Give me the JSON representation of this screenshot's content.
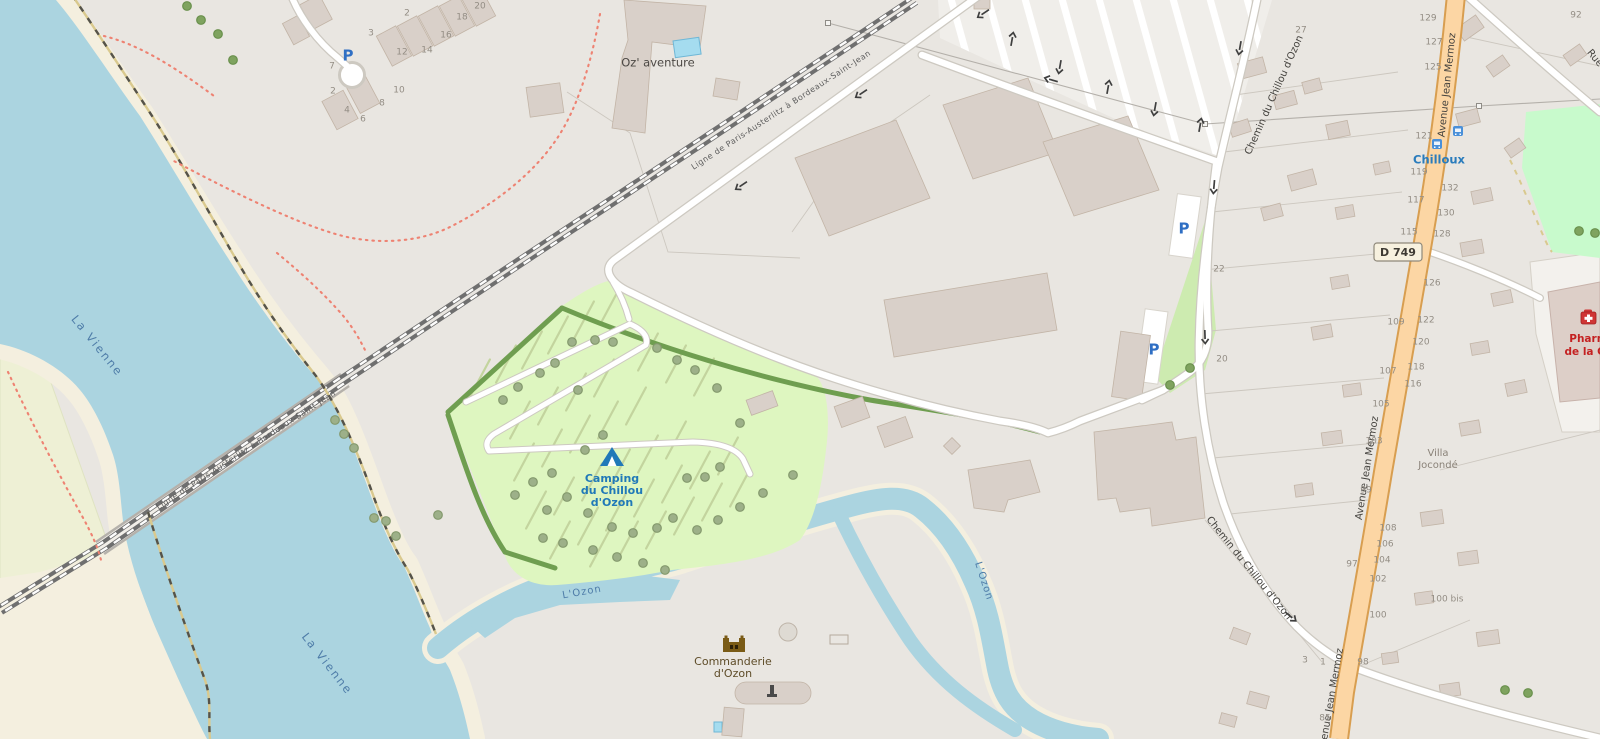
{
  "labels": {
    "la_vienne": "La Vienne",
    "l_ozon": "L'Ozon",
    "railway": "Ligne de Paris-Austerlitz à Bordeaux-Saint-Jean",
    "avenue": "Avenue Jean Mermoz",
    "chemin": "Chemin du Chillou d'Ozon",
    "rue_partial": "Rue",
    "road_ref": "D 749",
    "oz_aventure": "Oz' aventure",
    "camping_l1": "Camping",
    "camping_l2": "du Chillou",
    "camping_l3": "d'Ozon",
    "commanderie_l1": "Commanderie",
    "commanderie_l2": "d'Ozon",
    "bus_stop": "Chilloux",
    "pharmacy_l1": "Pharma",
    "pharmacy_l2": "de la Che",
    "villa_l1": "Villa",
    "villa_l2": "Jocondé",
    "parking": "P"
  },
  "house_numbers": [
    {
      "t": "129",
      "x": 1428,
      "y": 18
    },
    {
      "t": "127",
      "x": 1434,
      "y": 42
    },
    {
      "t": "125",
      "x": 1433,
      "y": 67
    },
    {
      "t": "121",
      "x": 1424,
      "y": 136
    },
    {
      "t": "119",
      "x": 1419,
      "y": 172
    },
    {
      "t": "117",
      "x": 1416,
      "y": 200
    },
    {
      "t": "115",
      "x": 1409,
      "y": 232
    },
    {
      "t": "132",
      "x": 1450,
      "y": 188
    },
    {
      "t": "130",
      "x": 1446,
      "y": 213
    },
    {
      "t": "128",
      "x": 1442,
      "y": 234
    },
    {
      "t": "126",
      "x": 1432,
      "y": 283
    },
    {
      "t": "122",
      "x": 1426,
      "y": 320
    },
    {
      "t": "120",
      "x": 1421,
      "y": 342
    },
    {
      "t": "118",
      "x": 1416,
      "y": 367
    },
    {
      "t": "116",
      "x": 1413,
      "y": 384
    },
    {
      "t": "109",
      "x": 1396,
      "y": 322
    },
    {
      "t": "107",
      "x": 1388,
      "y": 371
    },
    {
      "t": "105",
      "x": 1381,
      "y": 404
    },
    {
      "t": "103",
      "x": 1374,
      "y": 441
    },
    {
      "t": "99",
      "x": 1366,
      "y": 490
    },
    {
      "t": "97",
      "x": 1352,
      "y": 564
    },
    {
      "t": "108",
      "x": 1388,
      "y": 528
    },
    {
      "t": "106",
      "x": 1385,
      "y": 544
    },
    {
      "t": "104",
      "x": 1382,
      "y": 560
    },
    {
      "t": "102",
      "x": 1378,
      "y": 579
    },
    {
      "t": "100",
      "x": 1378,
      "y": 615
    },
    {
      "t": "100 bis",
      "x": 1447,
      "y": 599
    },
    {
      "t": "98",
      "x": 1363,
      "y": 662
    },
    {
      "t": "85",
      "x": 1325,
      "y": 718
    },
    {
      "t": "92",
      "x": 1576,
      "y": 15
    },
    {
      "t": "27",
      "x": 1301,
      "y": 30
    },
    {
      "t": "22",
      "x": 1219,
      "y": 269
    },
    {
      "t": "20",
      "x": 1222,
      "y": 359
    },
    {
      "t": "3",
      "x": 1305,
      "y": 660
    },
    {
      "t": "1",
      "x": 1323,
      "y": 662
    },
    {
      "t": "20",
      "x": 480,
      "y": 6
    },
    {
      "t": "18",
      "x": 462,
      "y": 17
    },
    {
      "t": "16",
      "x": 446,
      "y": 35
    },
    {
      "t": "14",
      "x": 427,
      "y": 50
    },
    {
      "t": "12",
      "x": 402,
      "y": 52
    },
    {
      "t": "10",
      "x": 399,
      "y": 90
    },
    {
      "t": "8",
      "x": 382,
      "y": 103
    },
    {
      "t": "6",
      "x": 363,
      "y": 119
    },
    {
      "t": "4",
      "x": 347,
      "y": 110
    },
    {
      "t": "2",
      "x": 333,
      "y": 91
    },
    {
      "t": "2",
      "x": 407,
      "y": 13
    },
    {
      "t": "3",
      "x": 371,
      "y": 33
    },
    {
      "t": "7",
      "x": 332,
      "y": 66
    }
  ],
  "palette": {
    "water": "#abd4e0",
    "land": "#e9e6e1",
    "sand": "#f4efdf",
    "farmland": "#eef0d5",
    "camp": "#def6c0",
    "grass": "#cdebb0",
    "park": "#c8facc",
    "building": "#d9d0c9",
    "building_stroke": "#c2b4a6",
    "road_primary": "#fcd6a4",
    "road_primary_casing": "#d89e50",
    "road_casing": "#cdc9c1",
    "railway": "#6f6f6f",
    "hedge": "#6f9e50",
    "path_red": "#ee8272",
    "label_water": "#4e7ca8",
    "label_poi_blue": "#2079b8",
    "label_brown": "#5e4c28",
    "label_red": "#c42121",
    "label_road": "#44423e",
    "house_number": "#938d84",
    "parking_blue": "#2f6fc4"
  }
}
